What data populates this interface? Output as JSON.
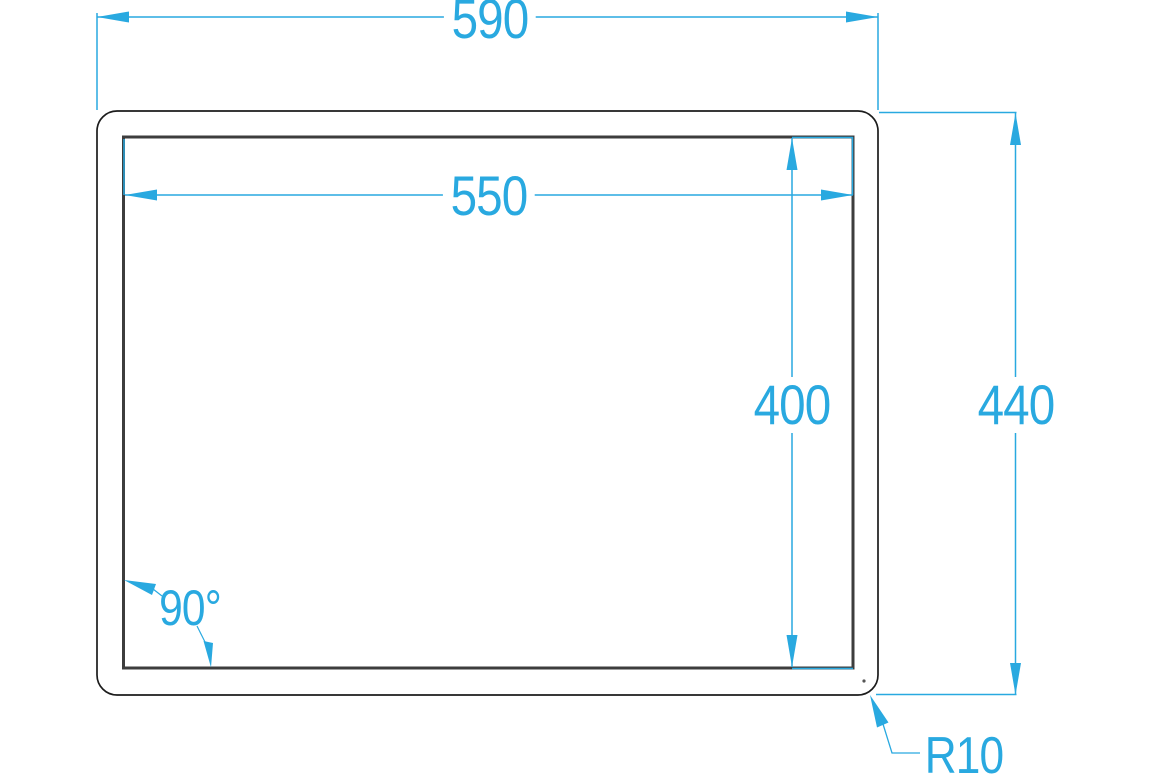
{
  "drawing": {
    "labels": {
      "outer_width": "590",
      "inner_width": "550",
      "inner_height": "400",
      "outer_height": "440",
      "corner_angle": "90°",
      "corner_radius": "R10"
    },
    "colors": {
      "dimension_accent": "#29A9E0",
      "outer_outline": "#1C1C1C",
      "inner_outline": "#3D3D3D",
      "background": "#FFFFFF"
    }
  }
}
